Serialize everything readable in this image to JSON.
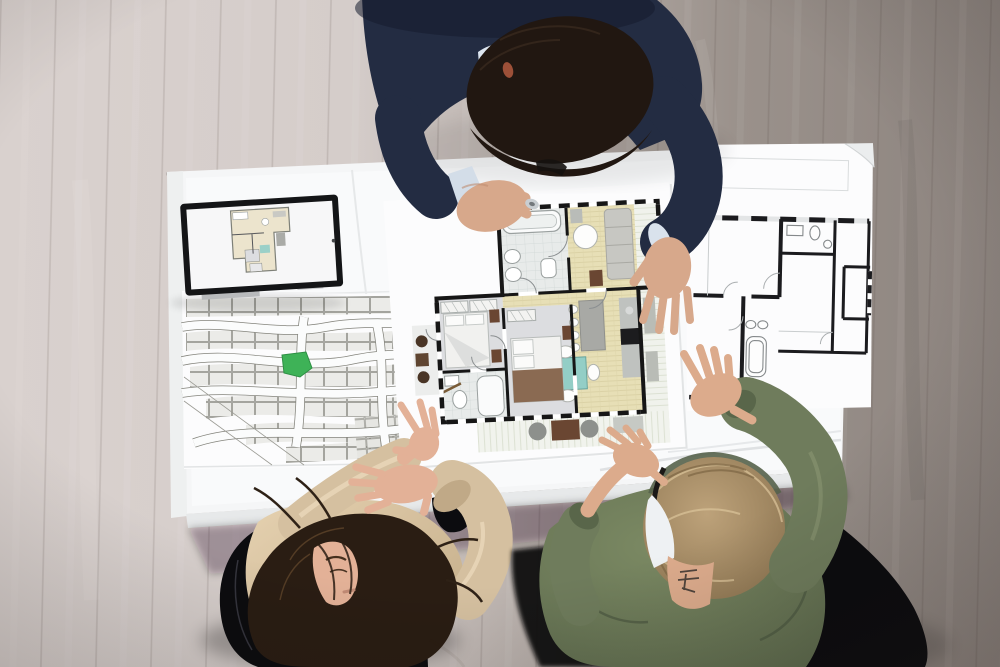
{
  "scene": {
    "description": "Top-down photo of a real-estate planning meeting: an architect in a navy suit and two clients review colored and blueprint floor plans, a plat map with a green highlighted lot, and a tablet on a white table over a wooden floor.",
    "labels": {
      "floor": "wooden office floor",
      "table": "white meeting table covered with plans",
      "tablet": "tablet computer showing a floor plan",
      "tabletScreen": "tablet screen with miniature floor plan",
      "platMap": "site plat map of building lots",
      "platHighlight": "green highlighted lot on plat map",
      "colorPlan": "colored apartment floor plan with furniture",
      "blueprint": "black and white blueprint floor plan",
      "architect": "architect in navy suit leaning over the table",
      "clientWoman": "woman with long dark hair in beige blouse",
      "clientMan": "man with glasses in olive green jacket",
      "chairWoman": "black office chair of the woman",
      "chairMan": "black office chair of the man",
      "ring": "small silver ring held in the architect's fingers",
      "pencil": "pencil lying on the colored floor plan"
    }
  },
  "colors": {
    "floorLight": "#d9d1ce",
    "floorDark": "#8d847f",
    "tableWhite": "#f5f6f7",
    "paper": "#fcfcfd",
    "navy": "#232c42",
    "shirt": "#dde6f0",
    "skinA": "#d7a88b",
    "hairDark": "#211711",
    "blouse": "#d5c0a0",
    "skinW": "#e3b197",
    "hairBrown": "#2a1d13",
    "olive": "#6f7c5c",
    "skinG": "#dcab8c",
    "hairSandy": "#b2946a",
    "chairBlack": "#0c0c0f",
    "woodPlan": "#e7dfb6",
    "tealTable": "#93cec6",
    "bedroomFloor": "#dcdde0",
    "tilePlan": "#e8ebea",
    "granite": "#a8a9a5",
    "sofaGray": "#c7c7c2",
    "deckLight": "#f1f3ed",
    "brownFurniture": "#6a4632",
    "parcelGreen": "#3eb257",
    "parcelGray": "#ebebe8",
    "planWall": "#161616",
    "blueprintLine": "#1b1b1e"
  }
}
